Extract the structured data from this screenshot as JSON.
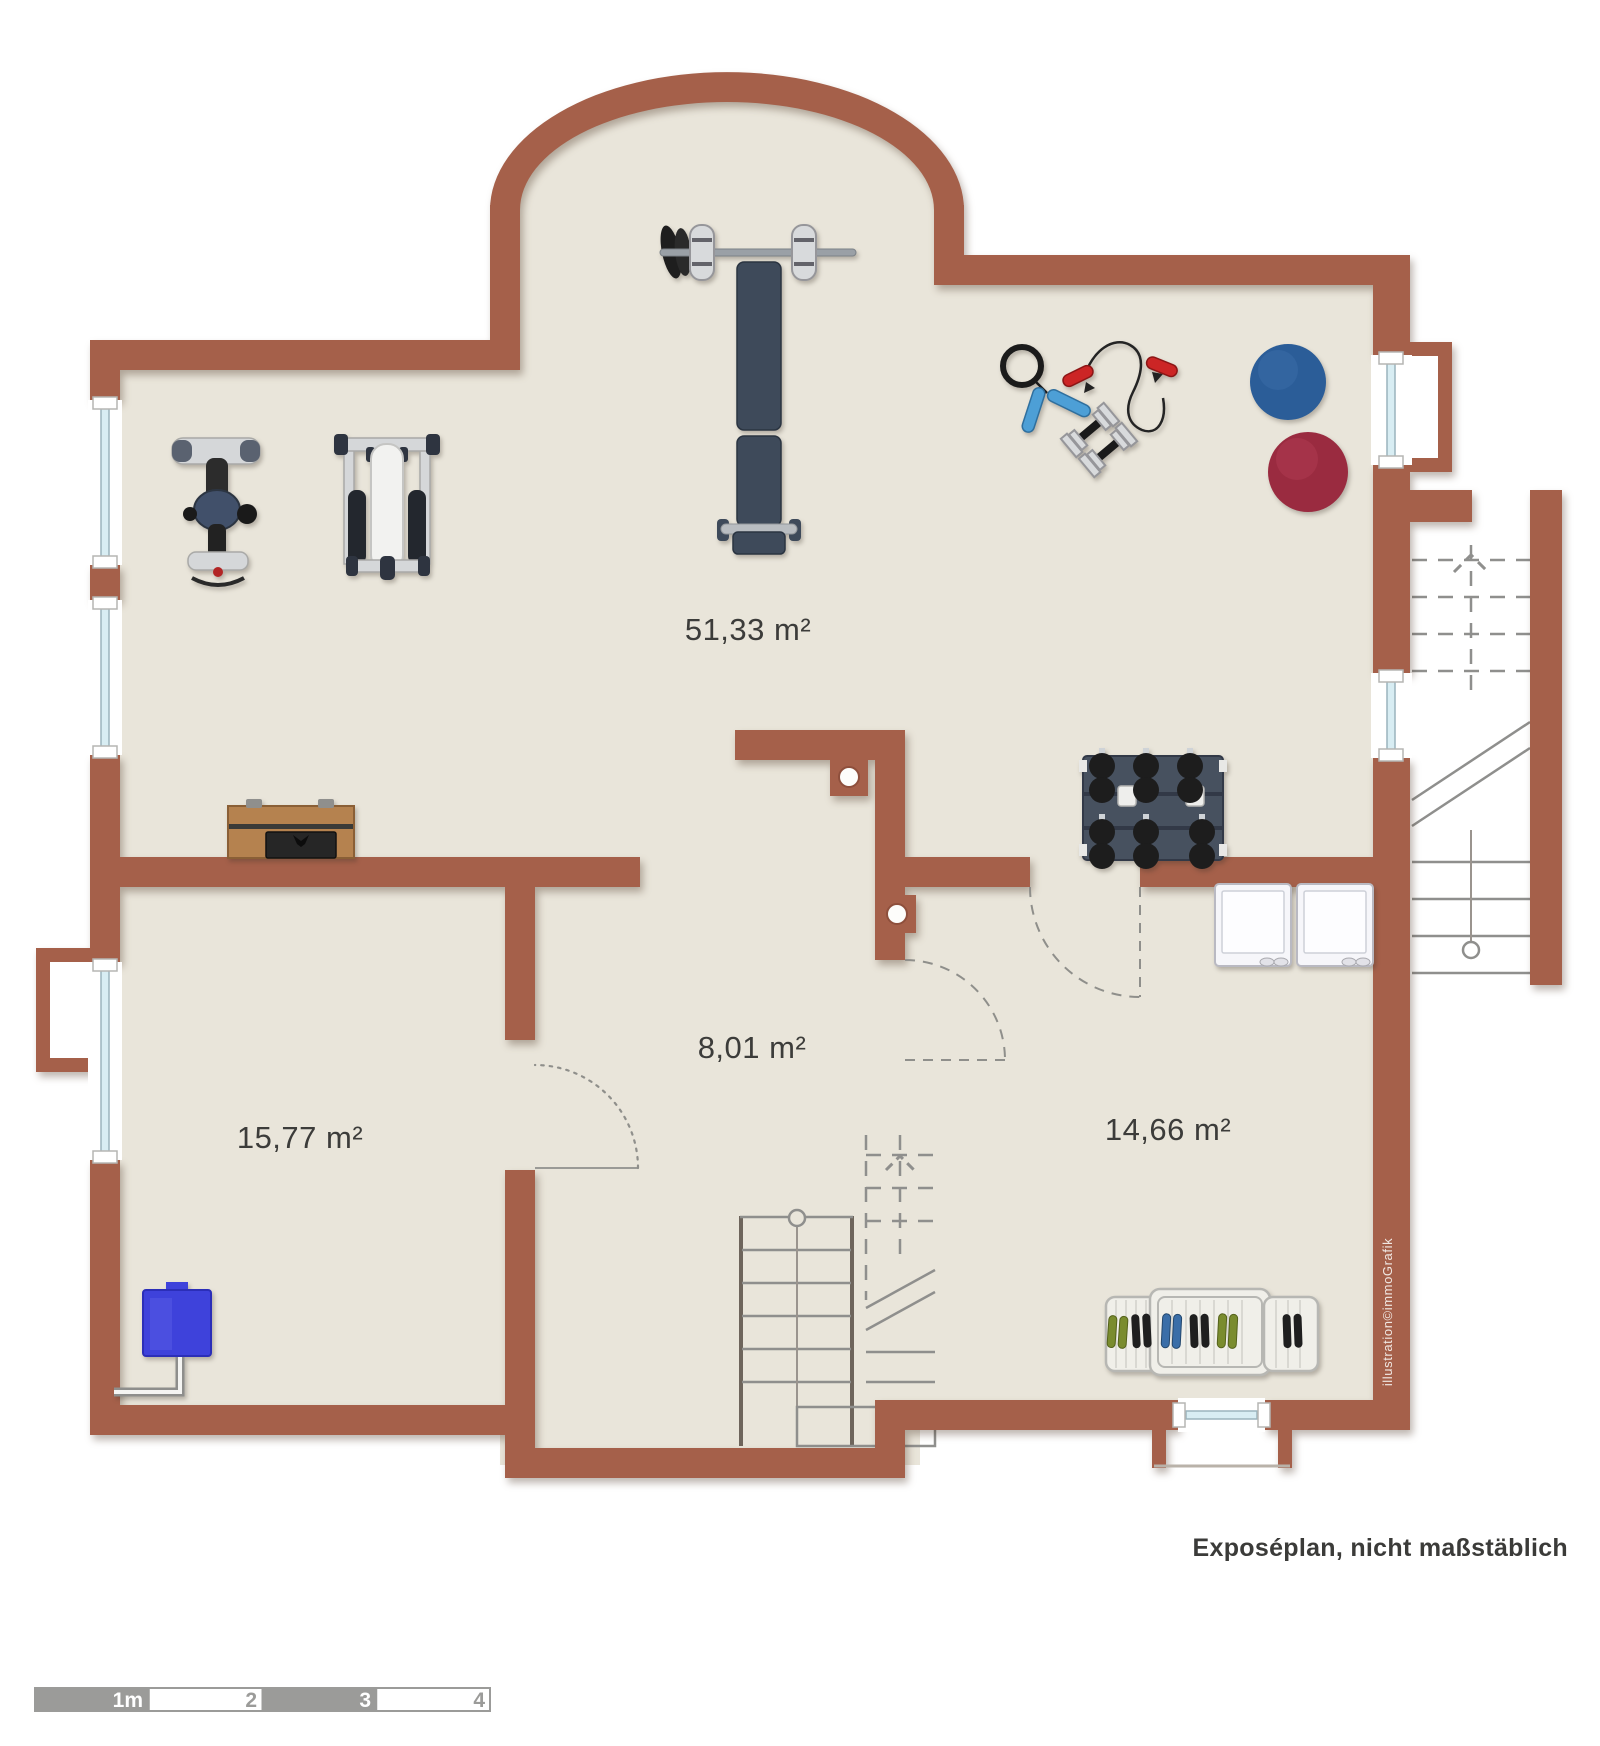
{
  "rooms": [
    {
      "id": "fitnessraum",
      "area_label": "51,33 m²"
    },
    {
      "id": "kellerraum-links",
      "area_label": "15,77 m²"
    },
    {
      "id": "flur",
      "area_label": "8,01 m²"
    },
    {
      "id": "kellerraum-rechts",
      "area_label": "14,66 m²"
    }
  ],
  "footnote": "Exposéplan, nicht maßstäblich",
  "watermark": "illustration©immoGrafik",
  "scale_bar": {
    "labels": [
      "1m",
      "2",
      "3",
      "4"
    ]
  },
  "furniture": [
    "bench-press",
    "exercise-bike",
    "multi-gym",
    "storage-chest",
    "jump-rope",
    "resistance-band",
    "hand-dumbbells",
    "gym-ball-blue",
    "gym-ball-red",
    "dumbbell-rack",
    "washing-machines",
    "shoe-rack",
    "water-tank",
    "staircase-center",
    "staircase-right"
  ],
  "colors": {
    "background": "#ffffff",
    "wall": "#a5604a",
    "floor": "#e9e5da",
    "stair_line": "#8f8f8d",
    "stair_rail": "#6e655c",
    "glass": "#d8edf3",
    "glass_edge": "#9ab4bd",
    "label_text": "#3c3c3a",
    "scale_gray": "#9b9b99",
    "ball_blue": "#2b5d98",
    "ball_red": "#9a2b40",
    "tank_blue": "#3e42db",
    "wood": "#b5824f",
    "equipment_dark": "#3e4a5a",
    "equipment_black": "#1d1d1d",
    "metal_light": "#d5d7d9",
    "handle_blue": "#4d9fd6",
    "handle_red": "#cc2525",
    "shoe_green": "#7a8c2e",
    "watermark_text": "#f0e7e2"
  }
}
